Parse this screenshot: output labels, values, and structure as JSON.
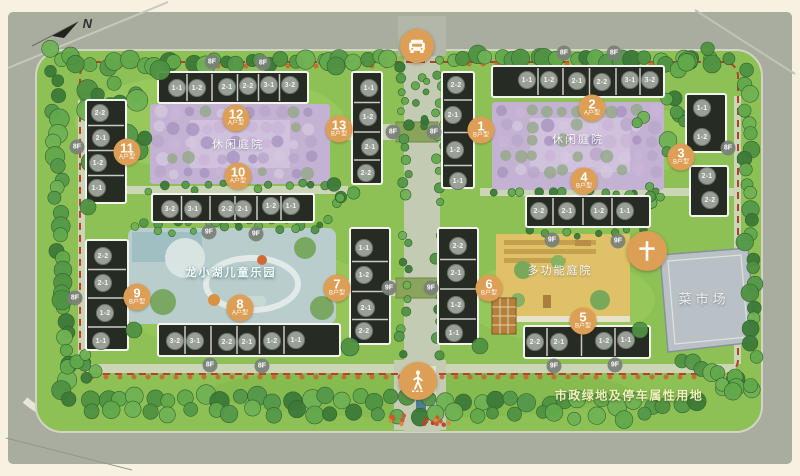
{
  "meta": {
    "north_label": "N"
  },
  "area_labels": [
    {
      "name": "leisure-courtyard-west",
      "text": "休闲庭院",
      "x": 238,
      "y": 144
    },
    {
      "name": "leisure-courtyard-east",
      "text": "休闲庭院",
      "x": 578,
      "y": 139
    },
    {
      "name": "children-park",
      "text": "龙小湖儿童乐园",
      "x": 231,
      "y": 272
    },
    {
      "name": "multifunction-courtyard",
      "text": "多功能庭院",
      "x": 560,
      "y": 270
    },
    {
      "name": "market",
      "text": "菜市场",
      "x": 704,
      "y": 298
    },
    {
      "name": "municipal-land",
      "text": "市政绿地及停车属性用地",
      "x": 629,
      "y": 395
    }
  ],
  "entrances": [
    {
      "name": "vehicle-entrance",
      "icon": "car-icon",
      "x": 417,
      "y": 46
    },
    {
      "name": "pedestrian-entrance",
      "icon": "pedestrian-icon",
      "x": 418,
      "y": 381
    },
    {
      "name": "feature-node",
      "icon": "cross-icon",
      "x": 647,
      "y": 251
    }
  ],
  "buildings": [
    {
      "num": "1",
      "type": "B户型",
      "badge": {
        "x": 481,
        "y": 130
      },
      "units": [
        {
          "t": "2-2",
          "x": 456,
          "y": 85
        },
        {
          "t": "2-1",
          "x": 453,
          "y": 115
        },
        {
          "t": "1-2",
          "x": 455,
          "y": 150
        },
        {
          "t": "1-1",
          "x": 458,
          "y": 181
        }
      ]
    },
    {
      "num": "2",
      "type": "A户型",
      "badge": {
        "x": 592,
        "y": 108
      },
      "units": [
        {
          "t": "1-1",
          "x": 527,
          "y": 80
        },
        {
          "t": "1-2",
          "x": 549,
          "y": 80
        },
        {
          "t": "2-1",
          "x": 577,
          "y": 81
        },
        {
          "t": "2-2",
          "x": 602,
          "y": 82
        },
        {
          "t": "3-1",
          "x": 630,
          "y": 80
        },
        {
          "t": "3-2",
          "x": 650,
          "y": 80
        }
      ]
    },
    {
      "num": "3",
      "type": "B户型",
      "badge": {
        "x": 681,
        "y": 157
      },
      "units": [
        {
          "t": "1-1",
          "x": 702,
          "y": 108
        },
        {
          "t": "1-2",
          "x": 702,
          "y": 137
        },
        {
          "t": "2-1",
          "x": 707,
          "y": 176
        },
        {
          "t": "2-2",
          "x": 710,
          "y": 200
        }
      ]
    },
    {
      "num": "4",
      "type": "B户型",
      "badge": {
        "x": 584,
        "y": 181
      },
      "units": [
        {
          "t": "2-2",
          "x": 539,
          "y": 211
        },
        {
          "t": "2-1",
          "x": 567,
          "y": 211
        },
        {
          "t": "1-2",
          "x": 599,
          "y": 211
        },
        {
          "t": "1-1",
          "x": 625,
          "y": 211
        }
      ]
    },
    {
      "num": "5",
      "type": "B户型",
      "badge": {
        "x": 583,
        "y": 321
      },
      "units": [
        {
          "t": "2-2",
          "x": 535,
          "y": 342
        },
        {
          "t": "2-1",
          "x": 559,
          "y": 342
        },
        {
          "t": "1-2",
          "x": 604,
          "y": 341
        },
        {
          "t": "1-1",
          "x": 626,
          "y": 340
        }
      ]
    },
    {
      "num": "6",
      "type": "B户型",
      "badge": {
        "x": 489,
        "y": 288
      },
      "units": [
        {
          "t": "2-2",
          "x": 458,
          "y": 246
        },
        {
          "t": "2-1",
          "x": 456,
          "y": 273
        },
        {
          "t": "1-2",
          "x": 456,
          "y": 305
        },
        {
          "t": "1-1",
          "x": 454,
          "y": 333
        }
      ]
    },
    {
      "num": "7",
      "type": "B户型",
      "badge": {
        "x": 337,
        "y": 288
      },
      "units": [
        {
          "t": "1-1",
          "x": 364,
          "y": 248
        },
        {
          "t": "1-2",
          "x": 364,
          "y": 275
        },
        {
          "t": "2-1",
          "x": 366,
          "y": 308
        },
        {
          "t": "2-2",
          "x": 364,
          "y": 331
        }
      ]
    },
    {
      "num": "8",
      "type": "A户型",
      "badge": {
        "x": 240,
        "y": 308
      },
      "units": [
        {
          "t": "3-2",
          "x": 175,
          "y": 341
        },
        {
          "t": "3-1",
          "x": 195,
          "y": 341
        },
        {
          "t": "2-2",
          "x": 227,
          "y": 342
        },
        {
          "t": "2-1",
          "x": 247,
          "y": 342
        },
        {
          "t": "1-2",
          "x": 272,
          "y": 341
        },
        {
          "t": "1-1",
          "x": 296,
          "y": 340
        }
      ]
    },
    {
      "num": "9",
      "type": "B户型",
      "badge": {
        "x": 137,
        "y": 297
      },
      "units": [
        {
          "t": "2-2",
          "x": 103,
          "y": 256
        },
        {
          "t": "2-1",
          "x": 103,
          "y": 283
        },
        {
          "t": "1-2",
          "x": 105,
          "y": 313
        },
        {
          "t": "1-1",
          "x": 101,
          "y": 341
        }
      ]
    },
    {
      "num": "10",
      "type": "A户型",
      "badge": {
        "x": 238,
        "y": 176
      },
      "units": [
        {
          "t": "3-2",
          "x": 170,
          "y": 209
        },
        {
          "t": "3-1",
          "x": 193,
          "y": 209
        },
        {
          "t": "2-2",
          "x": 227,
          "y": 209
        },
        {
          "t": "2-1",
          "x": 243,
          "y": 209
        },
        {
          "t": "1-2",
          "x": 271,
          "y": 206
        },
        {
          "t": "1-1",
          "x": 291,
          "y": 206
        }
      ]
    },
    {
      "num": "11",
      "type": "A户型",
      "badge": {
        "x": 127,
        "y": 152
      },
      "units": [
        {
          "t": "2-2",
          "x": 100,
          "y": 113
        },
        {
          "t": "2-1",
          "x": 101,
          "y": 138
        },
        {
          "t": "1-2",
          "x": 98,
          "y": 163
        },
        {
          "t": "1-1",
          "x": 97,
          "y": 188
        }
      ]
    },
    {
      "num": "12",
      "type": "A户型",
      "badge": {
        "x": 236,
        "y": 118
      },
      "units": [
        {
          "t": "1-1",
          "x": 177,
          "y": 88
        },
        {
          "t": "1-2",
          "x": 197,
          "y": 88
        },
        {
          "t": "2-1",
          "x": 227,
          "y": 87
        },
        {
          "t": "2-2",
          "x": 248,
          "y": 86
        },
        {
          "t": "3-1",
          "x": 269,
          "y": 85
        },
        {
          "t": "3-2",
          "x": 290,
          "y": 85
        }
      ]
    },
    {
      "num": "13",
      "type": "B户型",
      "badge": {
        "x": 339,
        "y": 129
      },
      "units": [
        {
          "t": "1-1",
          "x": 369,
          "y": 88
        },
        {
          "t": "1-2",
          "x": 368,
          "y": 117
        },
        {
          "t": "2-1",
          "x": 370,
          "y": 147
        },
        {
          "t": "2-2",
          "x": 366,
          "y": 173
        }
      ]
    }
  ],
  "floor_badges": [
    {
      "t": "8F",
      "x": 212,
      "y": 62
    },
    {
      "t": "8F",
      "x": 263,
      "y": 63
    },
    {
      "t": "8F",
      "x": 564,
      "y": 53
    },
    {
      "t": "8F",
      "x": 614,
      "y": 53
    },
    {
      "t": "8F",
      "x": 77,
      "y": 147
    },
    {
      "t": "8F",
      "x": 75,
      "y": 298
    },
    {
      "t": "8F",
      "x": 728,
      "y": 148
    },
    {
      "t": "8F",
      "x": 393,
      "y": 132
    },
    {
      "t": "8F",
      "x": 434,
      "y": 132
    },
    {
      "t": "9F",
      "x": 209,
      "y": 232
    },
    {
      "t": "9F",
      "x": 256,
      "y": 234
    },
    {
      "t": "9F",
      "x": 552,
      "y": 240
    },
    {
      "t": "9F",
      "x": 618,
      "y": 241
    },
    {
      "t": "9F",
      "x": 389,
      "y": 288
    },
    {
      "t": "9F",
      "x": 431,
      "y": 288
    },
    {
      "t": "8F",
      "x": 210,
      "y": 365
    },
    {
      "t": "8F",
      "x": 262,
      "y": 366
    },
    {
      "t": "9F",
      "x": 554,
      "y": 366
    },
    {
      "t": "9F",
      "x": 615,
      "y": 365
    }
  ],
  "colors": {
    "badge_orange": "#dd9f55",
    "floor_badge_grey": "#7a807a",
    "boundary_red": "#b5402e",
    "courtyard_purple": "#c3b2d2",
    "courtyard_yellow": "#dfc167",
    "park_blue": "#b9cdcd",
    "market_grey": "#b9c1c6",
    "grass_green": "#8dc155",
    "building_roof": "#262b23"
  }
}
